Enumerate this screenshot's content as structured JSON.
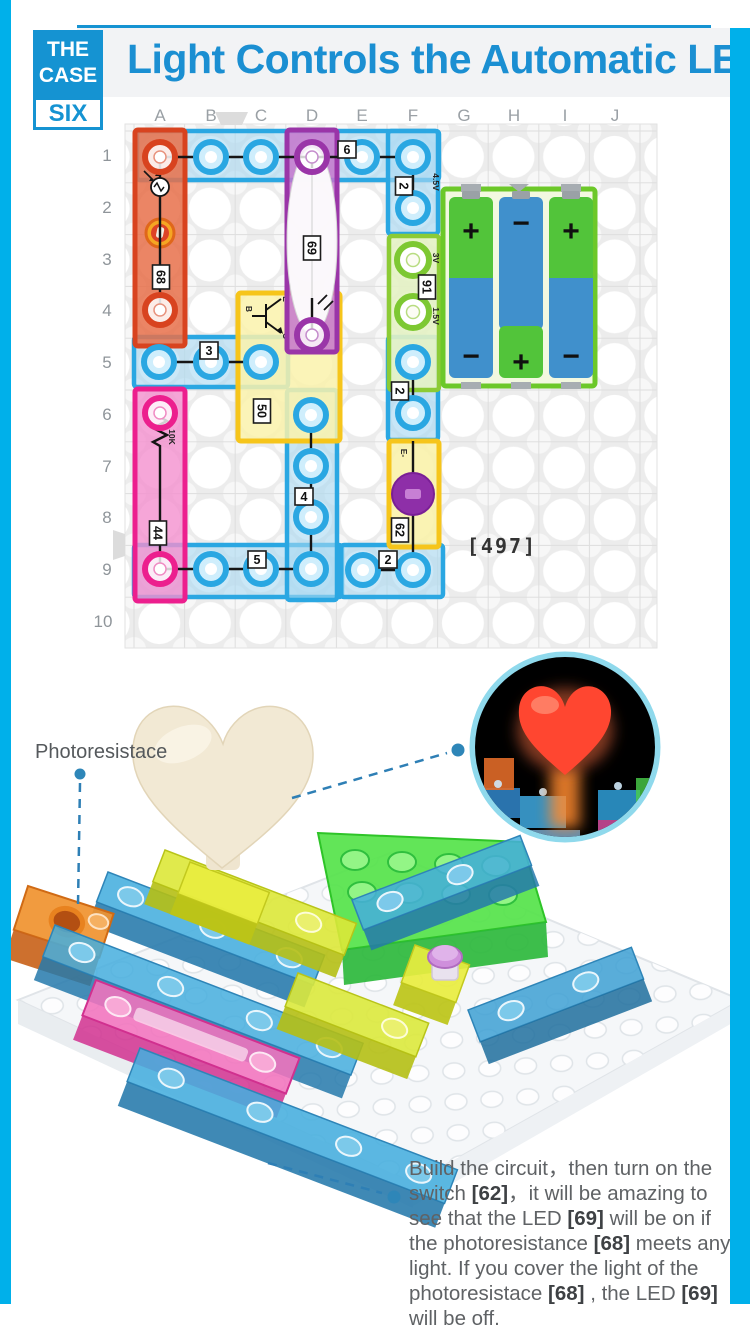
{
  "page": {
    "palette": {
      "frame": "#00b0ea",
      "header_blue": "#1593d2",
      "title_blue": "#1b8fd2",
      "block_red": "#d8431f",
      "block_blue": "#2aa7e2",
      "block_purple": "#9a35a8",
      "block_pink": "#ec1f8e",
      "block_yellow": "#f6c51b",
      "block_green": "#7dc832",
      "battery_green": "#52c43a",
      "battery_blue": "#4090cc",
      "inset_ring": "#8fd9ec",
      "heart_lit": "#ff4630",
      "heart_unlit": "#f2e9d4",
      "leader": "#2e7fb5",
      "text_gray": "#5f6265"
    }
  },
  "header": {
    "badge_line1": "THE",
    "badge_line2": "CASE",
    "badge_line3": "SIX",
    "title": "Light Controls the Automatic LED"
  },
  "diagram": {
    "columns": [
      "A",
      "B",
      "C",
      "D",
      "E",
      "F",
      "G",
      "H",
      "I",
      "J"
    ],
    "rows": [
      "1",
      "2",
      "3",
      "4",
      "5",
      "6",
      "7",
      "8",
      "9",
      "10"
    ],
    "board_code": "[497]",
    "labels": {
      "wire6": "6",
      "wire2_top": "2",
      "photoresistor": "68",
      "led": "69",
      "battery": "91",
      "battery_v_top": "4.5V",
      "battery_v_mid": "3V",
      "battery_v_low": "1.5V",
      "wire3": "3",
      "resistor": "44",
      "resistor_value": "10K",
      "transistor": "50",
      "transistor_b": "B",
      "transistor_e": "E",
      "transistor_c": "C",
      "wire4": "4",
      "wire2_mid": "2",
      "switch": "62",
      "switch_e": "E-",
      "wire5": "5",
      "wire2_bottom": "2",
      "plus": "+",
      "minus": "−"
    }
  },
  "photo": {
    "callout": "Photoresistace"
  },
  "instructions": {
    "segments": [
      {
        "t": "Build the circuit，then turn on the switch "
      },
      {
        "t": "[62]",
        "b": true
      },
      {
        "t": "，it will be amazing to see that the LED "
      },
      {
        "t": "[69]",
        "b": true
      },
      {
        "t": " will be on if the photoresistance "
      },
      {
        "t": "[68]",
        "b": true
      },
      {
        "t": " meets any light. If you cover the light of the photoresistace "
      },
      {
        "t": "[68]",
        "b": true
      },
      {
        "t": " , the LED "
      },
      {
        "t": "[69]",
        "b": true
      },
      {
        "t": " will be off."
      }
    ]
  }
}
